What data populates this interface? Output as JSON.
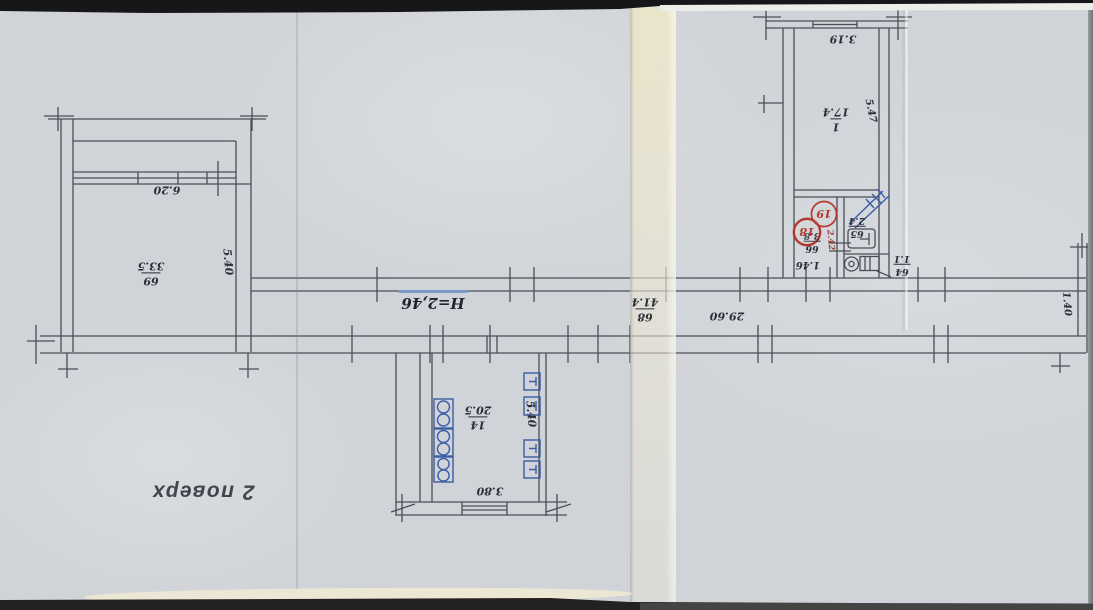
{
  "floor_label": "2 поверх",
  "ceiling_height_note": "H=2,46",
  "rooms": {
    "room69": {
      "number": "69",
      "area": "33.5"
    },
    "room68": {
      "number": "68",
      "area": "41.4"
    },
    "room14": {
      "number": "14",
      "area": "20.5"
    },
    "room1": {
      "number": "1",
      "area": "17.4"
    },
    "room65": {
      "number": "65",
      "area": "2.4"
    },
    "room66": {
      "number": "66",
      "area": "3.8"
    },
    "room64": {
      "number": "64",
      "area": "1.1"
    }
  },
  "dimensions": {
    "left_room_window": "6.20",
    "left_room_depth": "5.40",
    "corridor_length": "29.60",
    "corridor_end_width": "1.40",
    "kitchen_window": "3.80",
    "kitchen_depth": "5.40",
    "room1_width": "3.19",
    "room1_depth": "5.47",
    "bath_depth": "2.42",
    "door_width": "1.46"
  },
  "markup": {
    "circle18": "18",
    "circle19": "19"
  },
  "colors": {
    "paper": "#d0d3d7",
    "ink": "#4b4e56",
    "blue_ink": "#3a5ea6",
    "red_ink": "#b5362e",
    "underline_blue": "#7b9ac6",
    "fold_cream": "#ece5ca"
  }
}
